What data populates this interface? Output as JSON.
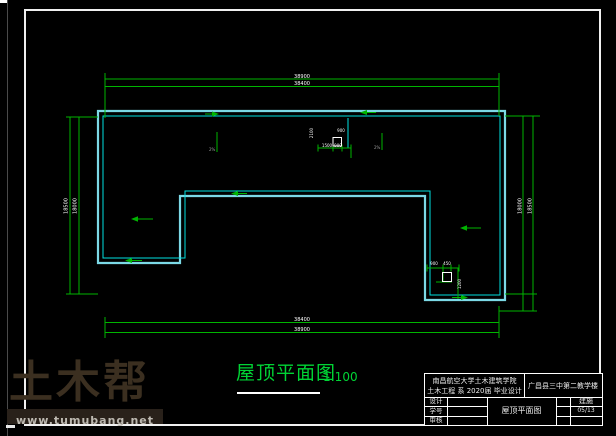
{
  "drawing": {
    "title": "屋顶平面图",
    "scale": "1:100"
  },
  "title_block": {
    "school_line1": "南昌航空大学土木建筑学院",
    "school_line2": "土木工程 系 2020届 毕业设计",
    "project": "广昌县三中第二教学楼",
    "row_labels": [
      "设计",
      "学号",
      "审核"
    ],
    "drawing_title": "屋顶平面图",
    "category": "建施",
    "sheet_no": "05/13"
  },
  "watermark": {
    "logo": "土木帮",
    "site": "www.tumubang.net"
  },
  "dimensions": {
    "top_outer": "38900",
    "top_inner": "38400",
    "bottom_first": "38400",
    "bottom_second": "38900",
    "left_outer": "18500",
    "left_inner": "18000",
    "right_inner": "18000",
    "right_outer": "18500"
  },
  "details": {
    "stair_dim_top": "900",
    "stair_dim_left": "1500",
    "stair_dim_right": "900",
    "stair_dim_side": "2100",
    "drain_dim1": "900",
    "drain_dim2": "450",
    "drain_dim_side": "1200",
    "slope_label1": "2%",
    "slope_label2": "2%"
  },
  "colors": {
    "wall_outer": "#7CD9E6",
    "wall_inner": "#00E0E0",
    "dimension": "#00B400",
    "title_green": "#00D435",
    "watermark_text": "#3B2F20",
    "watermark_bar_bg": "#29211A",
    "watermark_bar_text": "#BDB9B1"
  }
}
